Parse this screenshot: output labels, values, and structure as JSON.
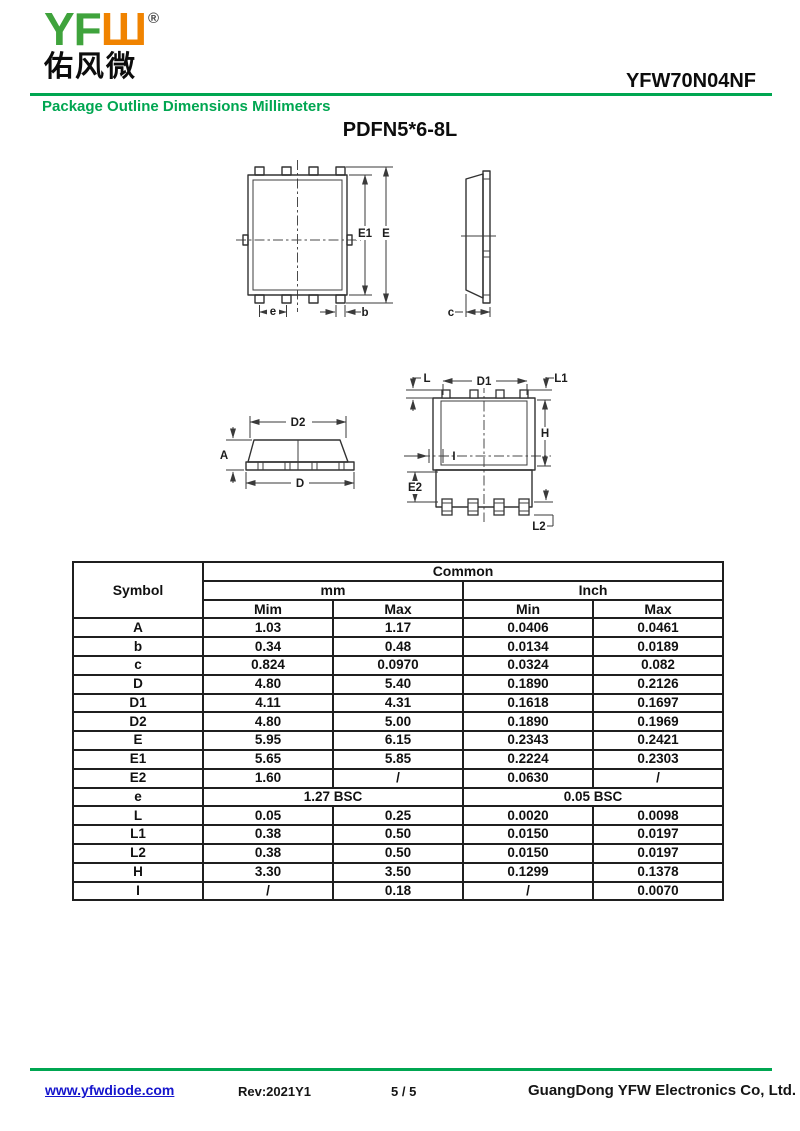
{
  "header": {
    "logo": {
      "yf": "YF",
      "w": "Ш",
      "registered": "®",
      "chinese": "佑风微"
    },
    "part_number": "YFW70N04NF",
    "section_title": "Package Outline Dimensions Millimeters"
  },
  "title": "PDFN5*6-8L",
  "diagram_labels": {
    "E1": "E1",
    "E": "E",
    "e": "e",
    "b": "b",
    "c": "c",
    "D2": "D2",
    "A": "A",
    "D": "D",
    "D1": "D1",
    "L": "L",
    "L1": "L1",
    "H": "H",
    "E2": "E2",
    "L2": "L2",
    "I": "I"
  },
  "table": {
    "header": {
      "symbol": "Symbol",
      "common": "Common",
      "mm": "mm",
      "inch": "Inch",
      "mm_min": "Mim",
      "mm_max": "Max",
      "inch_min": "Min",
      "inch_max": "Max"
    },
    "rows": [
      {
        "symbol": "A",
        "mm_min": "1.03",
        "mm_max": "1.17",
        "inch_min": "0.0406",
        "inch_max": "0.0461"
      },
      {
        "symbol": "b",
        "mm_min": "0.34",
        "mm_max": "0.48",
        "inch_min": "0.0134",
        "inch_max": "0.0189"
      },
      {
        "symbol": "c",
        "mm_min": "0.824",
        "mm_max": "0.0970",
        "inch_min": "0.0324",
        "inch_max": "0.082"
      },
      {
        "symbol": "D",
        "mm_min": "4.80",
        "mm_max": "5.40",
        "inch_min": "0.1890",
        "inch_max": "0.2126"
      },
      {
        "symbol": "D1",
        "mm_min": "4.11",
        "mm_max": "4.31",
        "inch_min": "0.1618",
        "inch_max": "0.1697"
      },
      {
        "symbol": "D2",
        "mm_min": "4.80",
        "mm_max": "5.00",
        "inch_min": "0.1890",
        "inch_max": "0.1969"
      },
      {
        "symbol": "E",
        "mm_min": "5.95",
        "mm_max": "6.15",
        "inch_min": "0.2343",
        "inch_max": "0.2421"
      },
      {
        "symbol": "E1",
        "mm_min": "5.65",
        "mm_max": "5.85",
        "inch_min": "0.2224",
        "inch_max": "0.2303"
      },
      {
        "symbol": "E2",
        "mm_min": "1.60",
        "mm_max": "/",
        "inch_min": "0.0630",
        "inch_max": "/"
      },
      {
        "symbol": "e",
        "mm_bsc": "1.27 BSC",
        "inch_bsc": "0.05 BSC"
      },
      {
        "symbol": "L",
        "mm_min": "0.05",
        "mm_max": "0.25",
        "inch_min": "0.0020",
        "inch_max": "0.0098"
      },
      {
        "symbol": "L1",
        "mm_min": "0.38",
        "mm_max": "0.50",
        "inch_min": "0.0150",
        "inch_max": "0.0197"
      },
      {
        "symbol": "L2",
        "mm_min": "0.38",
        "mm_max": "0.50",
        "inch_min": "0.0150",
        "inch_max": "0.0197"
      },
      {
        "symbol": "H",
        "mm_min": "3.30",
        "mm_max": "3.50",
        "inch_min": "0.1299",
        "inch_max": "0.1378"
      },
      {
        "symbol": "I",
        "mm_min": "/",
        "mm_max": "0.18",
        "inch_min": "/",
        "inch_max": "0.0070"
      }
    ]
  },
  "footer": {
    "website": "www.yfwdiode.com",
    "revision": "Rev:2021Y1",
    "page": "5 / 5",
    "company": "GuangDong YFW Electronics Co, Ltd."
  },
  "colors": {
    "green": "#00A651",
    "logo_green": "#3FA33C",
    "logo_orange": "#F08300",
    "link_blue": "#1515CD"
  }
}
